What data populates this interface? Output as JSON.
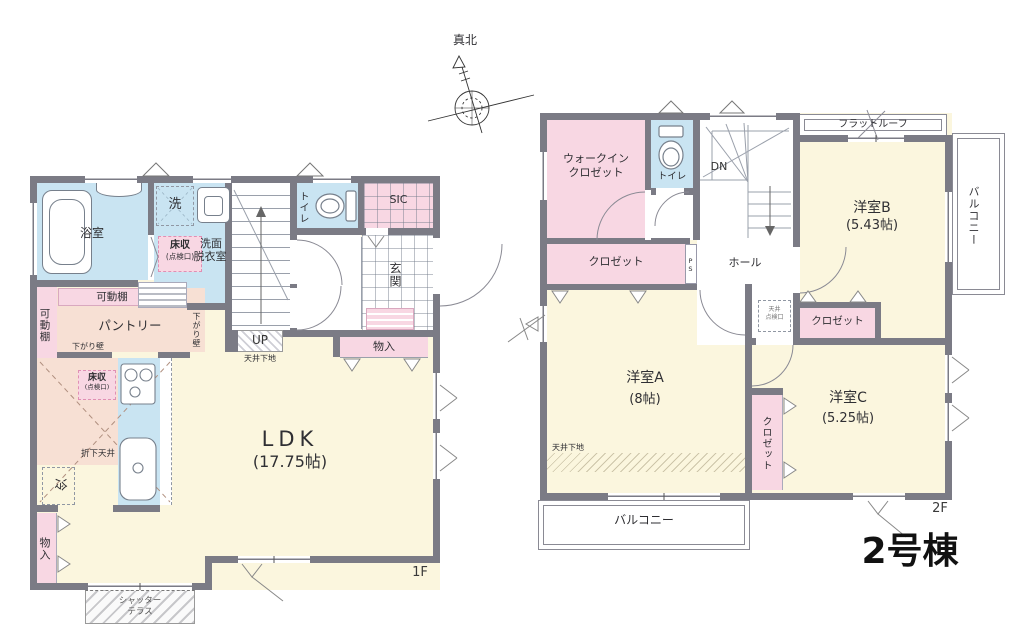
{
  "colors": {
    "wall": "#7b7b85",
    "cream": "#fbf6de",
    "blue": "#c9e4f2",
    "pink": "#f8d7e3",
    "peach": "#f7e0d4",
    "line": "#8a8a94",
    "text": "#2f2f33"
  },
  "compass": {
    "north_label": "真北"
  },
  "building": {
    "name": "2号棟"
  },
  "f1": {
    "floor_label": "1F",
    "bath": "浴室",
    "washer": "洗",
    "floor_storage_1": "床収",
    "floor_storage_1b": "(点検口)",
    "washroom_1": "洗面",
    "washroom_2": "脱衣室",
    "toilet": "トイレ",
    "sic": "SIC",
    "entrance": "玄関",
    "shelf_top": "可動棚",
    "shelf_left": "可動棚",
    "pantry": "パントリー",
    "lowered_wall_h": "下がり壁",
    "lowered_wall_v": "下がり壁",
    "up": "UP",
    "ceiling_base": "天井下地",
    "storage_hall": "物入",
    "floor_storage_2": "床収",
    "floor_storage_2b": "(点検口)",
    "dropped_ceiling": "折下天井",
    "fridge": "冷",
    "ldk_name": "LDK",
    "ldk_size": "(17.75帖)",
    "storage_kitchen": "物入",
    "terrace_1": "シャッター",
    "terrace_2": "テラス"
  },
  "f2": {
    "floor_label": "2F",
    "wic_1": "ウォークイン",
    "wic_2": "クロゼット",
    "toilet": "トイレ",
    "dn": "DN",
    "flat_roof": "フラットルーフ",
    "closet_a": "クロゼット",
    "ps": "PS",
    "hall": "ホール",
    "room_b_name": "洋室B",
    "room_b_size": "(5.43帖)",
    "balcony_right": "バルコニー",
    "room_a_name": "洋室A",
    "room_a_size": "(8帖)",
    "ceiling_base": "天井下地",
    "hatch_label_1": "天井",
    "hatch_label_2": "点検口",
    "closet_b": "クロゼット",
    "room_c_name": "洋室C",
    "room_c_size": "(5.25帖)",
    "closet_c": "クロゼット",
    "balcony_bottom": "バルコニー"
  }
}
